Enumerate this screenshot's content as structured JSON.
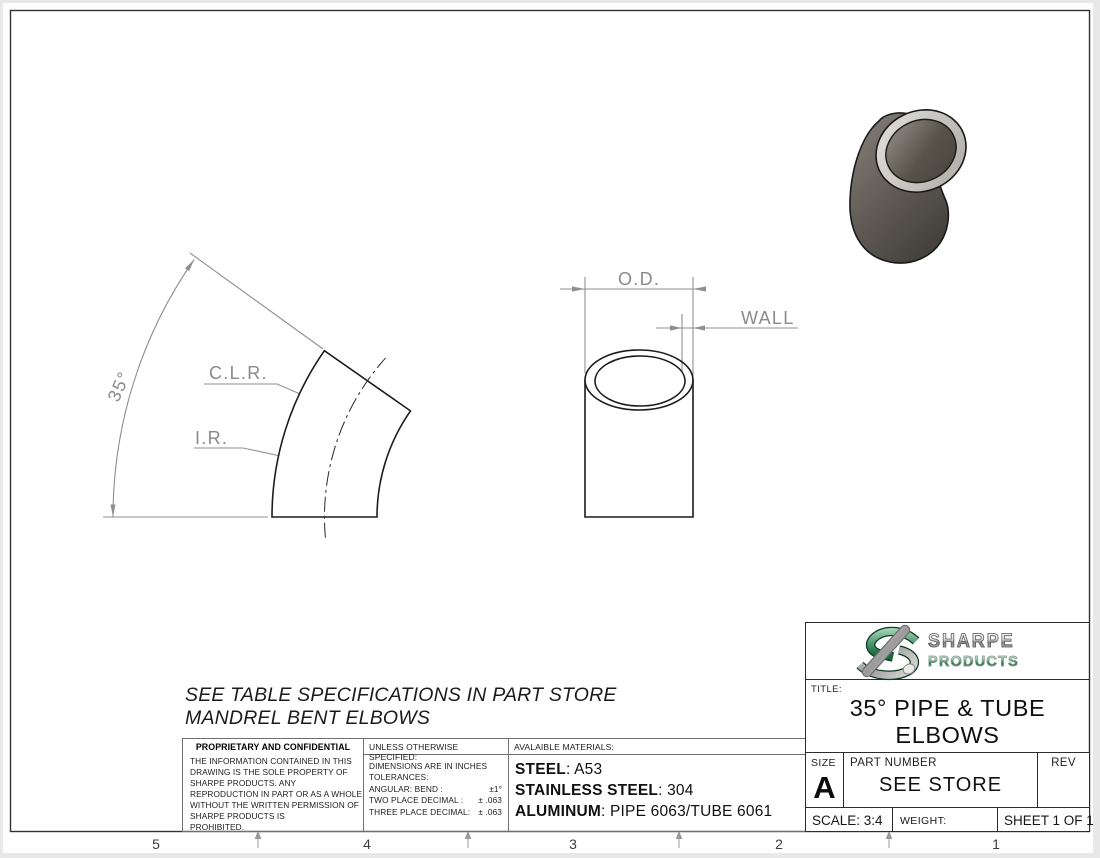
{
  "sheet": {
    "zone_numbers": [
      "5",
      "4",
      "3",
      "2",
      "1"
    ]
  },
  "views": {
    "elbow_view": {
      "angle_dim": "35°",
      "clr_label": "C.L.R.",
      "ir_label": "I.R."
    },
    "tube_section": {
      "od_label": "O.D.",
      "wall_label": "WALL"
    }
  },
  "spec_note": {
    "line1": "SEE TABLE SPECIFICATIONS IN PART STORE",
    "line2": "MANDREL BENT ELBOWS"
  },
  "proprietary": {
    "heading": "PROPRIETARY AND CONFIDENTIAL",
    "lines": [
      "THE INFORMATION CONTAINED IN THIS",
      "DRAWING IS THE SOLE PROPERTY OF",
      "SHARPE PRODUCTS.  ANY",
      "REPRODUCTION IN PART OR AS A WHOLE",
      "WITHOUT THE WRITTEN PERMISSION OF",
      "SHARPE PRODUCTS IS",
      "PROHIBITED."
    ]
  },
  "tolerances": {
    "heading": "UNLESS OTHERWISE SPECIFIED:",
    "lines": [
      "DIMENSIONS ARE IN INCHES",
      "TOLERANCES:"
    ],
    "rows": [
      {
        "label": "ANGULAR: BEND :",
        "value": "±1°"
      },
      {
        "label": "TWO PLACE DECIMAL  :",
        "value": "± .063"
      },
      {
        "label": "THREE PLACE DECIMAL:",
        "value": "± .063"
      }
    ]
  },
  "materials": {
    "heading": "AVALAIBLE MATERIALS:",
    "items": [
      {
        "label": "STEEL",
        "value": ": A53"
      },
      {
        "label": "STAINLESS STEEL",
        "value": ": 304"
      },
      {
        "label": "ALUMINUM",
        "value": ": PIPE 6063/TUBE 6061"
      }
    ]
  },
  "title_block": {
    "logo_line1": "SHARPE",
    "logo_line2": "PRODUCTS",
    "title_label": "TITLE:",
    "title_line1": "35° PIPE & TUBE",
    "title_line2": "ELBOWS",
    "size_label": "SIZE",
    "size_value": "A",
    "part_number_label": "PART NUMBER",
    "part_number_value": "SEE STORE",
    "rev_label": "REV",
    "scale_text": "SCALE: 3:4",
    "weight_text": "WEIGHT:",
    "sheet_text": "SHEET 1 OF 1"
  },
  "colors": {
    "logo_green": "#1d6f42",
    "dim_gray": "#8f8f8f",
    "line_black": "#1c1c1c"
  }
}
